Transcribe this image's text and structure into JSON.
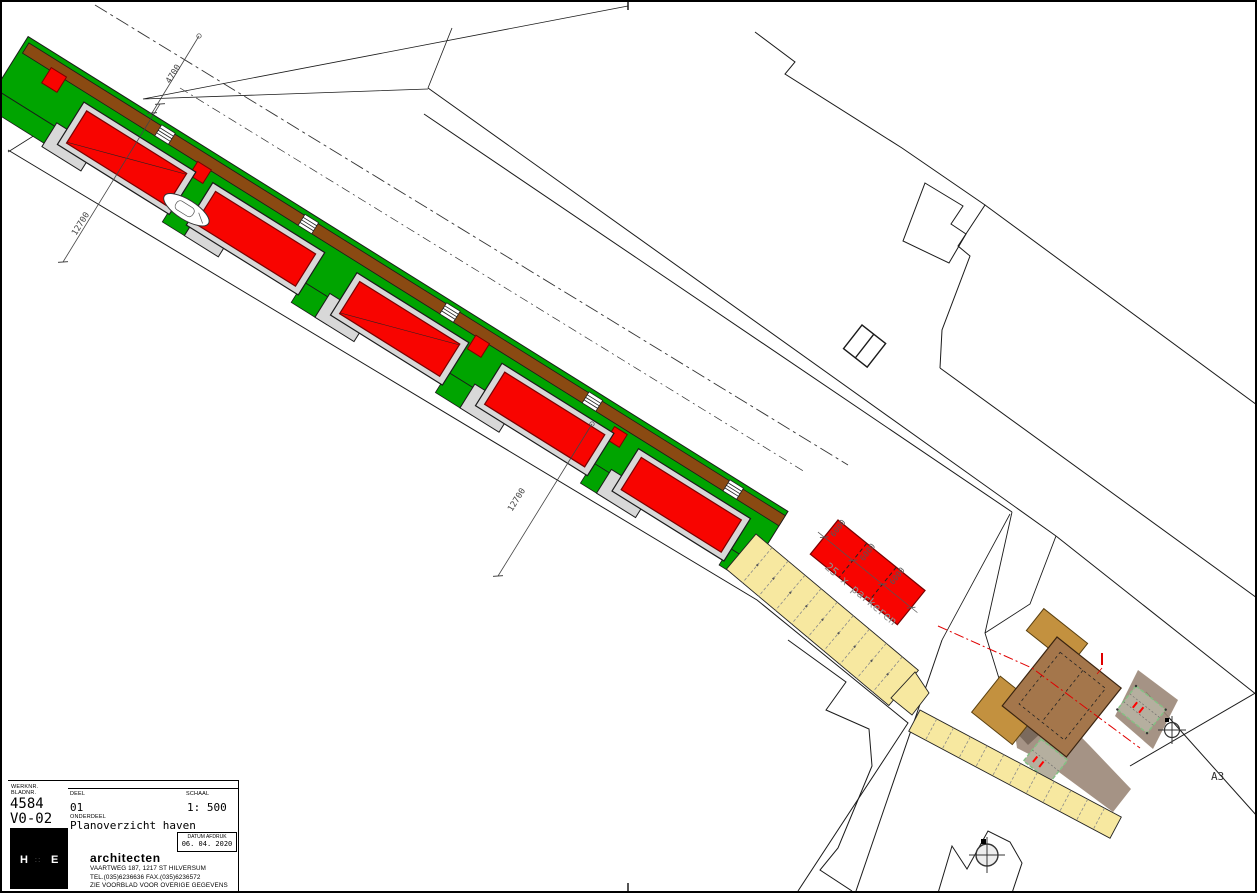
{
  "colors": {
    "grass_green": "#00a400",
    "road_brown": "#8a4a12",
    "building_red": "#f80400",
    "building_red_border": "#7a0000",
    "surround_gray": "#d8d8d8",
    "parking_yellow": "#f7e8a0",
    "tan_building": "#c3913f",
    "dark_brown_building": "#a4764b",
    "driveway_taupe": "#9b8778",
    "outbuilding_gray": "#b5af9f",
    "outbuilding_dash_green": "#84c084",
    "accent_red": "#ff0000",
    "line_black": "#1a1a1a",
    "dim_gray": "#444444"
  },
  "plan": {
    "dim_12700": "12700",
    "dim_4700": "4700",
    "dim_6000": "6000",
    "parking_label": "25 x parkeren",
    "sheet_size_label": "A3"
  },
  "title_block": {
    "werknr_label": "WERKNR.",
    "bladnr_label": "BLADNR.",
    "werknr": "4584",
    "blad": "V0-02",
    "deel_label": "DEEL",
    "deel": "01",
    "schaal_label": "SCHAAL",
    "schaal": "1: 500",
    "onderdeel_label": "ONDERDEEL",
    "onderdeel": "Planoverzicht haven",
    "datum_label": "DATUM AFDRUK",
    "datum": "06. 04. 2020",
    "logo_left": "H",
    "logo_mark": "∷",
    "logo_right": "E",
    "firm": "architecten",
    "address": "VAARTWEG 187, 1217 ST HILVERSUM",
    "phone": "TEL.(035)6236636  FAX.(035)6236572",
    "note": "ZIE VOORBLAD VOOR OVERIGE GEGEVENS"
  }
}
